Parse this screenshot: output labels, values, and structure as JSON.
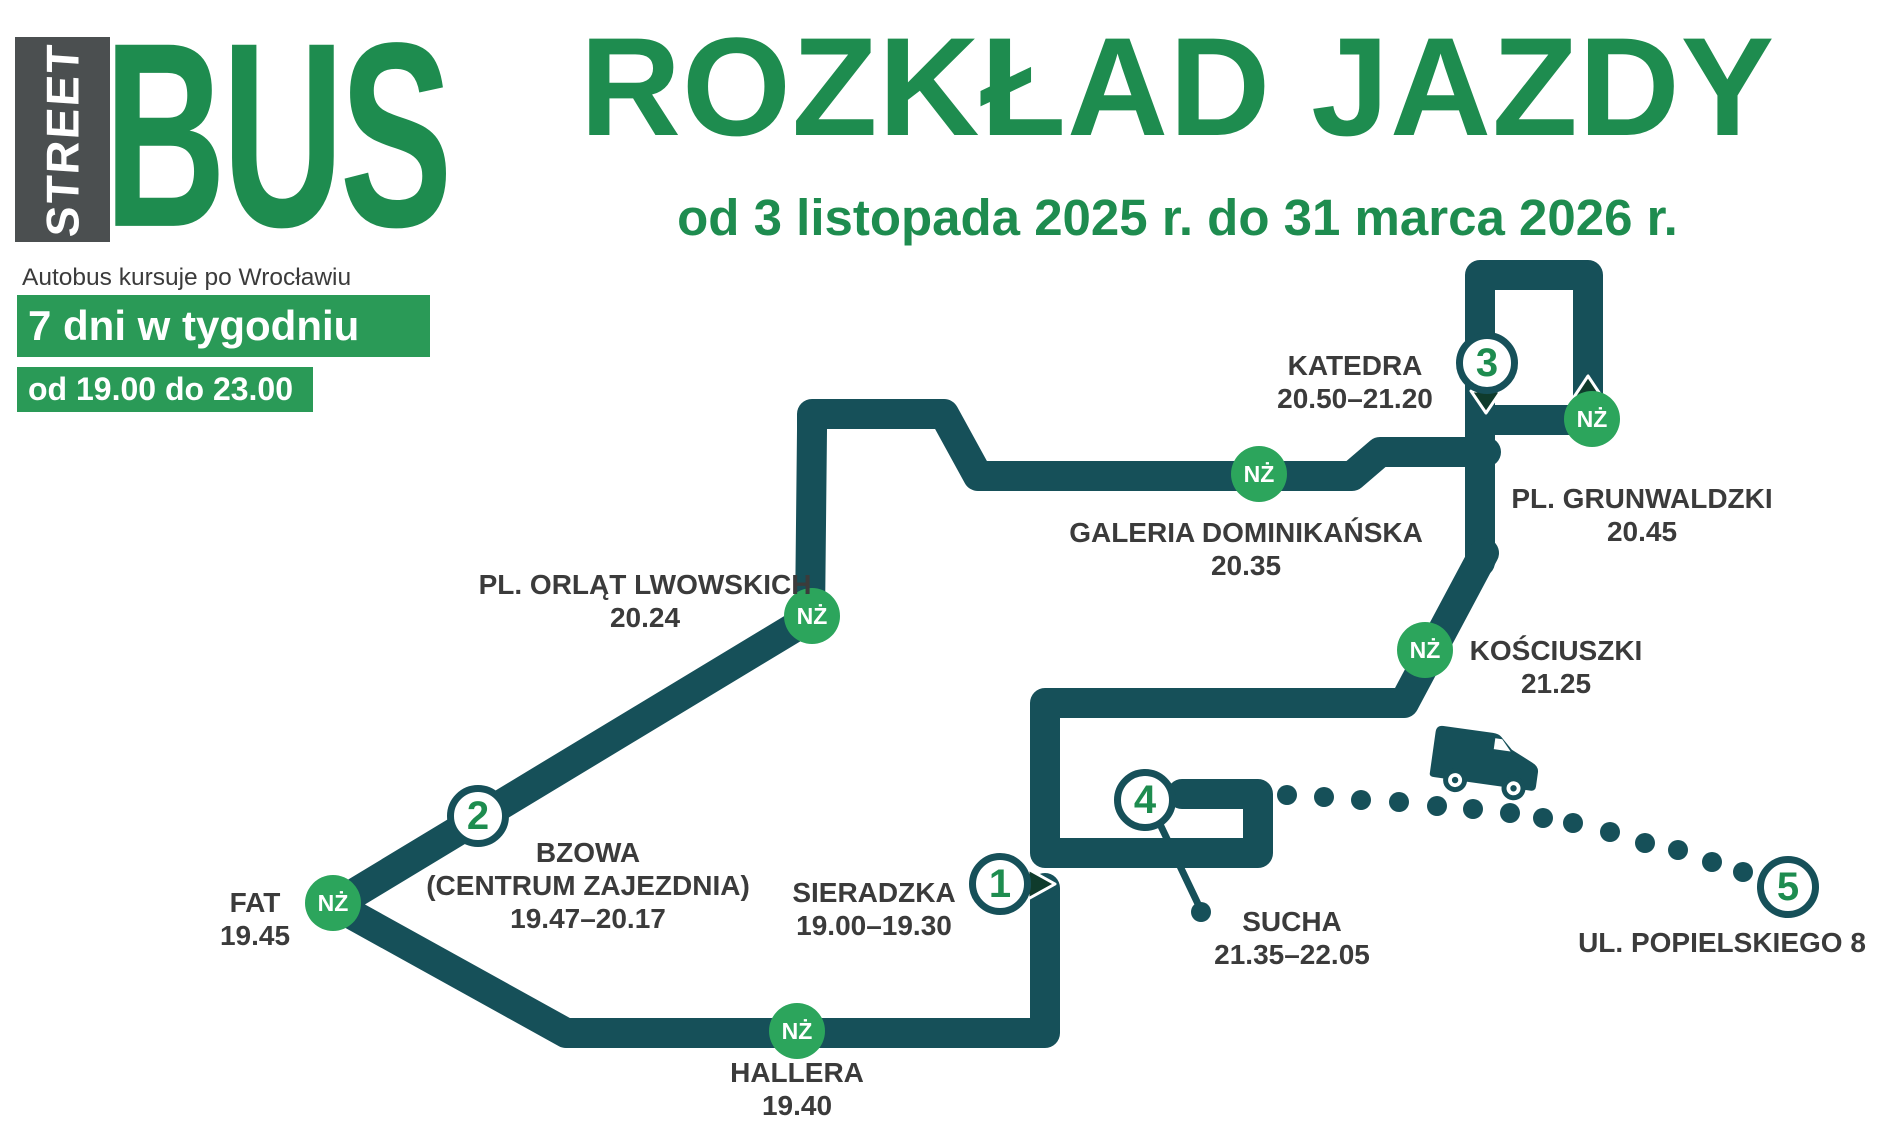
{
  "colors": {
    "route_teal": "#165059",
    "brand_green": "#1E8C4F",
    "box_green": "#2A9A57",
    "badge_green": "#2CA55C",
    "text_dark": "#3B3B3B",
    "logo_box_gray": "#4B4F50",
    "direction_triangle": "#0F3B2C"
  },
  "logo": {
    "street": "STREET",
    "bus": "BUS",
    "tagline": "Autobus kursuje po Wrocławiu",
    "days": "7 dni w tygodniu",
    "hours": "od 19.00 do 23.00"
  },
  "title": "ROZKŁAD JAZDY",
  "subtitle": "od 3 listopada 2025 r. do 31 marca 2026 r.",
  "icons": {
    "request_stop_badge": "NŻ",
    "direction_down_triangle": "▼",
    "direction_up_triangle": "▲",
    "route_start_arrow": "▶",
    "bus_icon": "bus-van",
    "dotted_trail": "depot-deadhead-dots"
  },
  "stops": {
    "sieradzka": {
      "number": "1",
      "name": "SIERADZKA",
      "time": "19.00–19.30"
    },
    "hallera": {
      "badge": "NŻ",
      "name": "HALLERA",
      "time": "19.40"
    },
    "fat": {
      "badge": "NŻ",
      "name": "FAT",
      "time": "19.45"
    },
    "bzowa": {
      "number": "2",
      "name": "BZOWA",
      "name2": "(CENTRUM ZAJEZDNIA)",
      "time": "19.47–20.17"
    },
    "orlat": {
      "badge": "NŻ",
      "name": "PL. ORLĄT LWOWSKICH",
      "time": "20.24"
    },
    "galeria": {
      "badge": "NŻ",
      "name": "GALERIA DOMINIKAŃSKA",
      "time": "20.35"
    },
    "grunwaldzki": {
      "badge": "NŻ",
      "name": "PL. GRUNWALDZKI",
      "time": "20.45"
    },
    "katedra": {
      "number": "3",
      "name": "KATEDRA",
      "time": "20.50–21.20"
    },
    "kosciuszki": {
      "badge": "NŻ",
      "name": "KOŚCIUSZKI",
      "time": "21.25"
    },
    "sucha": {
      "number": "4",
      "name": "SUCHA",
      "time": "21.35–22.05"
    },
    "popielskiego": {
      "number": "5",
      "name": "UL. POPIELSKIEGO 8"
    }
  }
}
